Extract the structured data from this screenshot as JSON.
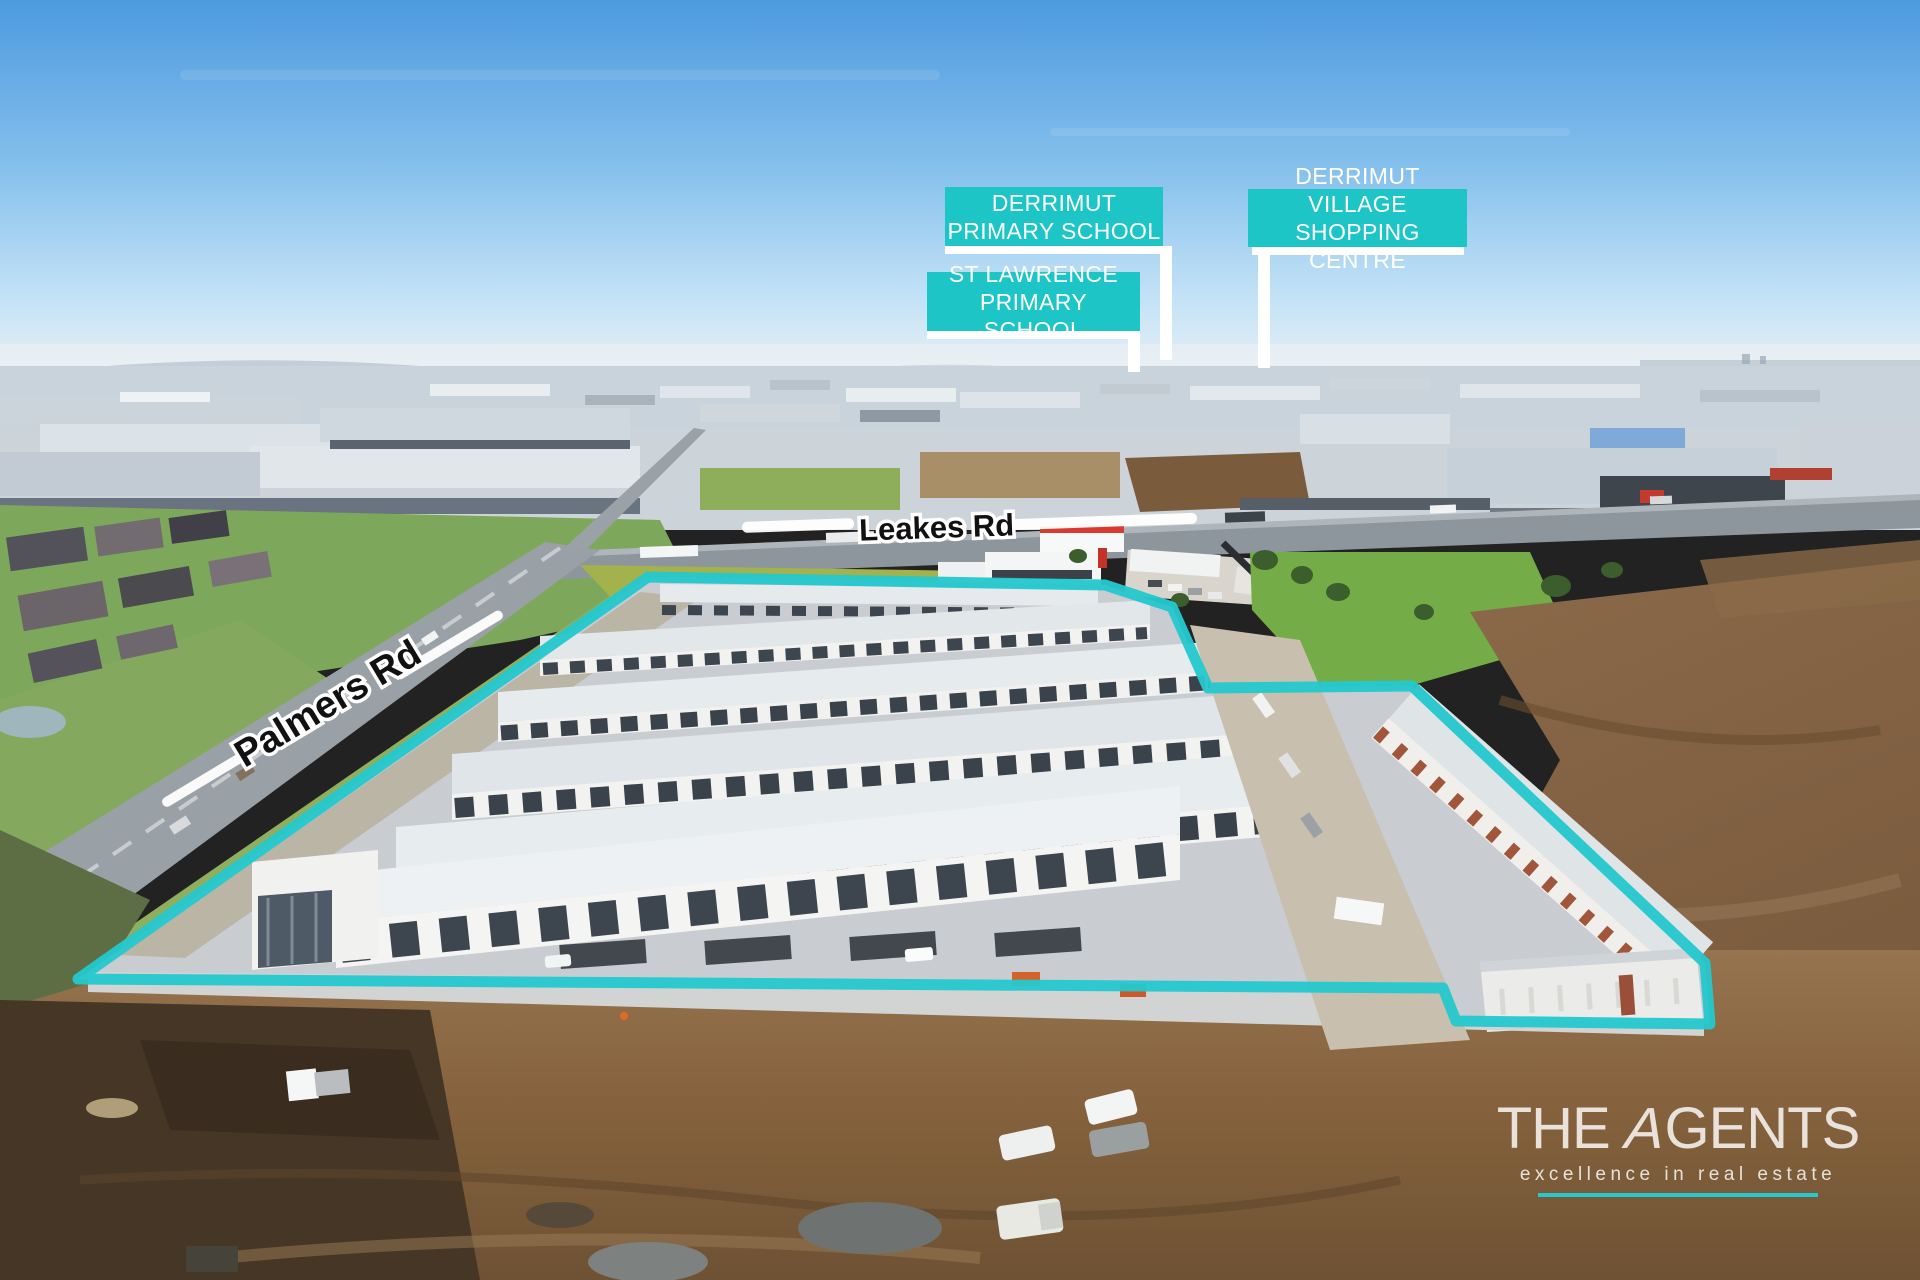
{
  "landmarks": {
    "derrimut_primary": {
      "line1": "DERRIMUT",
      "line2": "PRIMARY SCHOOL"
    },
    "st_lawrence_primary": {
      "line1": "ST LAWRENCE",
      "line2": "PRIMARY SCHOOL"
    },
    "derrimut_village": {
      "line1": "DERRIMUT VILLAGE",
      "line2": "SHOPPING CENTRE"
    }
  },
  "roads": {
    "leakes": "Leakes Rd",
    "palmers": "Palmers Rd"
  },
  "logo": {
    "brand_the": "THE ",
    "brand_a": "A",
    "brand_gents": "GENTS",
    "tagline": "excellence in real estate"
  },
  "colors": {
    "label_teal": "#1ec5c6",
    "boundary_teal": "#25c8cd",
    "label_text": "#ffffff",
    "road_text": "#111111",
    "logo_text": "rgba(255,255,255,0.82)"
  }
}
